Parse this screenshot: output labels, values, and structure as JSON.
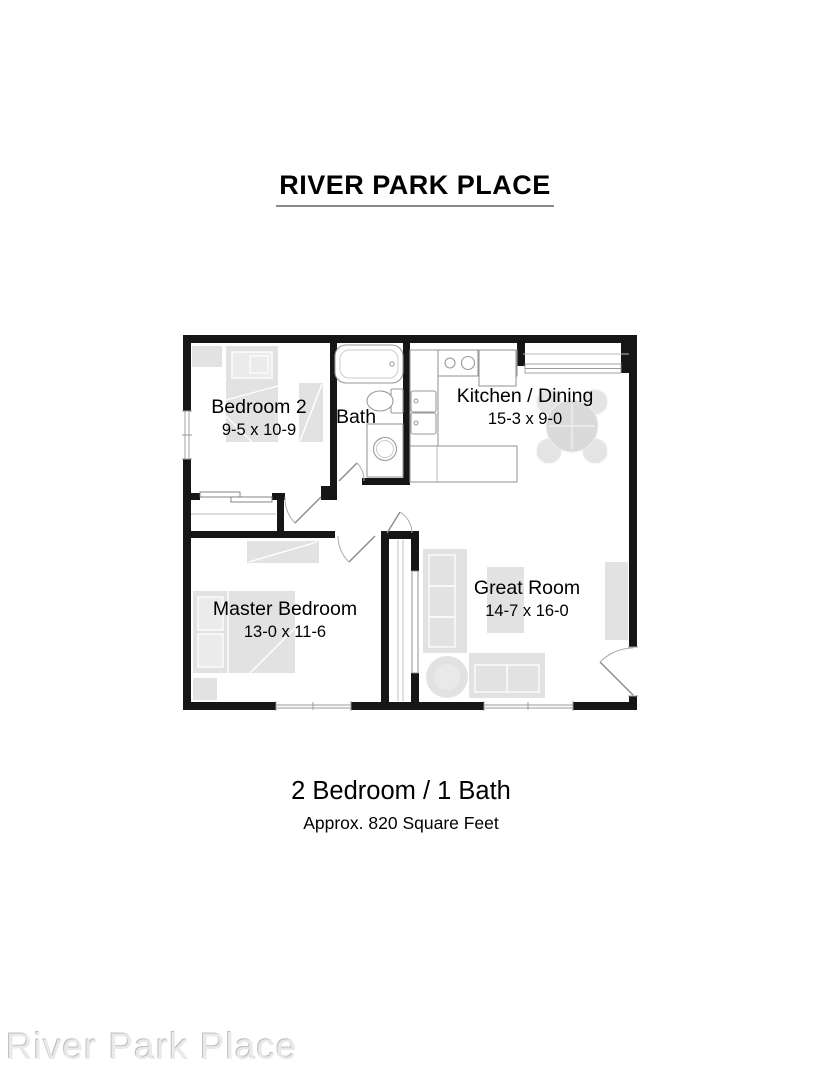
{
  "header": {
    "title": "RIVER PARK PLACE"
  },
  "floor_plan": {
    "rooms": {
      "bedroom2": {
        "name": "Bedroom 2",
        "dimensions": "9-5 x 10-9"
      },
      "bath": {
        "name": "Bath"
      },
      "kitchen_dining": {
        "name": "Kitchen / Dining",
        "dimensions": "15-3 x 9-0"
      },
      "master_bedroom": {
        "name": "Master Bedroom",
        "dimensions": "13-0 x 11-6"
      },
      "great_room": {
        "name": "Great Room",
        "dimensions": "14-7 x 16-0"
      }
    },
    "fixtures": [
      "bathtub",
      "toilet",
      "vanity-sink",
      "range",
      "refrigerator",
      "kitchen-sink",
      "counter-peninsula",
      "dining-table",
      "bed",
      "nightstand",
      "dresser",
      "closet-rod",
      "sofa",
      "loveseat",
      "round-table",
      "media-console",
      "entry-door",
      "windows"
    ],
    "colors": {
      "wall": "#161616",
      "furniture": "#e2e2e2",
      "fixture_outline": "#999999"
    }
  },
  "summary": {
    "beds_baths": "2 Bedroom / 1 Bath",
    "area": "Approx. 820 Square Feet"
  },
  "watermark": {
    "text": "River Park Place",
    "color": "#e9e9e9"
  }
}
